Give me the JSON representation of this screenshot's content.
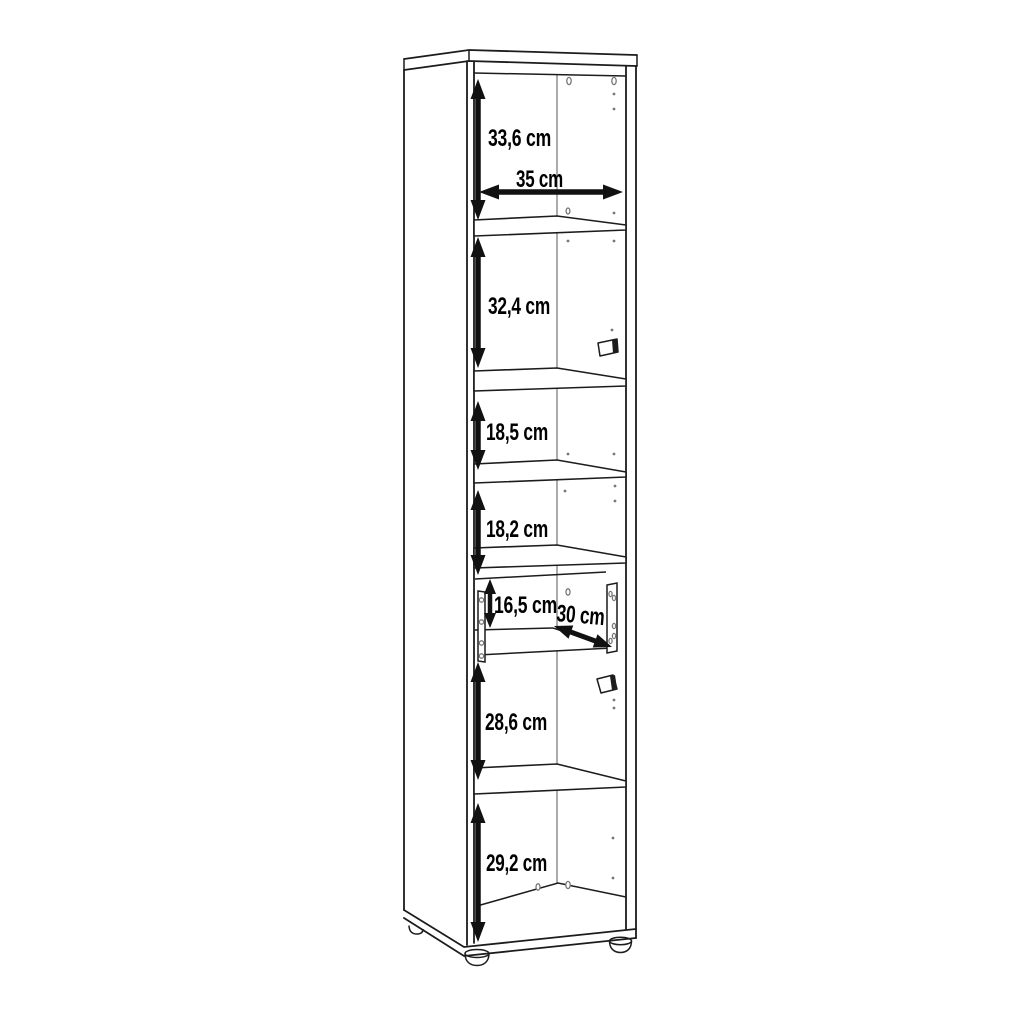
{
  "diagram": {
    "kind": "furniture-dimension-line-drawing",
    "unit": "cm"
  },
  "labels": {
    "compartment_1_height": "33,6 cm",
    "interior_width": "35 cm",
    "compartment_2_height": "32,4 cm",
    "compartment_3_height": "18,5 cm",
    "compartment_4_height": "18,2 cm",
    "niche_height": "16,5 cm",
    "niche_depth": "30 cm",
    "compartment_5_height": "28,6 cm",
    "compartment_6_height": "29,2 cm"
  },
  "measurements": [
    {
      "name": "compartment-1-height",
      "value": 33.6,
      "unit": "cm",
      "orientation": "vertical"
    },
    {
      "name": "interior-width",
      "value": 35,
      "unit": "cm",
      "orientation": "horizontal"
    },
    {
      "name": "compartment-2-height",
      "value": 32.4,
      "unit": "cm",
      "orientation": "vertical"
    },
    {
      "name": "compartment-3-height",
      "value": 18.5,
      "unit": "cm",
      "orientation": "vertical"
    },
    {
      "name": "compartment-4-height",
      "value": 18.2,
      "unit": "cm",
      "orientation": "vertical"
    },
    {
      "name": "niche-height",
      "value": 16.5,
      "unit": "cm",
      "orientation": "vertical"
    },
    {
      "name": "niche-depth",
      "value": 30,
      "unit": "cm",
      "orientation": "diagonal"
    },
    {
      "name": "compartment-5-height",
      "value": 28.6,
      "unit": "cm",
      "orientation": "vertical"
    },
    {
      "name": "compartment-6-height",
      "value": 29.2,
      "unit": "cm",
      "orientation": "vertical"
    }
  ],
  "colors": {
    "line": "#1c1c1c",
    "secondary_line": "#8f8f8f",
    "dimension": "#111111",
    "text": "#000000",
    "background": "#ffffff"
  }
}
